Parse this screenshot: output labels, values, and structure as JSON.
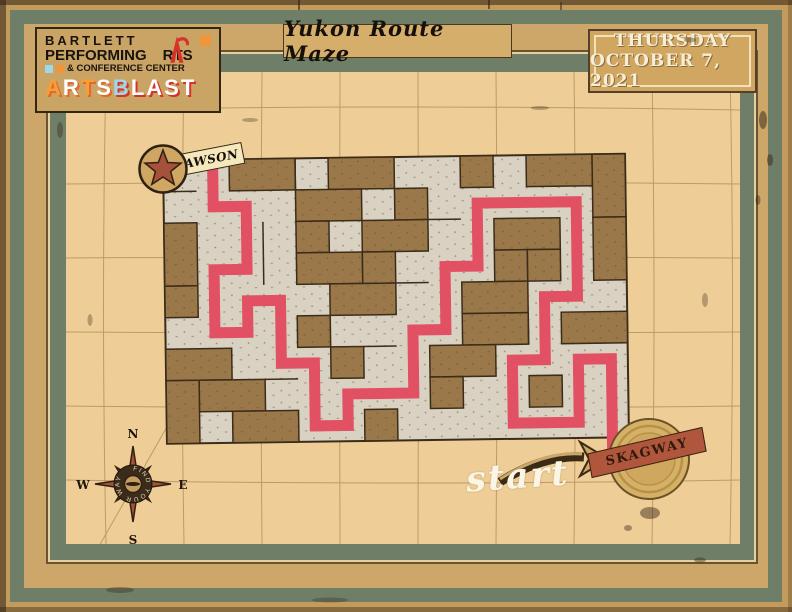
{
  "title": "Yukon Route Maze",
  "event_date": {
    "line1": "THURSDAY",
    "line2": "OCTOBER 7, 2021"
  },
  "logo": {
    "line1": "BARTLETT",
    "line2_pre": "PERFORMING",
    "line2_post": "RTS",
    "line3": "& CONFERENCE CENTER",
    "artsblast": [
      {
        "ch": "A",
        "color": "#f69f36",
        "shadow": "#e4692c"
      },
      {
        "ch": "R",
        "color": "#ffffff",
        "shadow": "#e4692c"
      },
      {
        "ch": "T",
        "color": "#f69f36",
        "shadow": "#e4692c"
      },
      {
        "ch": "S",
        "color": "#ffffff",
        "shadow": "#e4692c"
      },
      {
        "ch": "B",
        "color": "#9ed8ea",
        "shadow": "#d9322b"
      },
      {
        "ch": "L",
        "color": "#ffffff",
        "shadow": "#d9322b"
      },
      {
        "ch": "A",
        "color": "#ffffff",
        "shadow": "#d9322b"
      },
      {
        "ch": "S",
        "color": "#ffffff",
        "shadow": "#d9322b"
      },
      {
        "ch": "T",
        "color": "#ffffff",
        "shadow": "#d9322b"
      }
    ]
  },
  "labels": {
    "start": "start",
    "dawson": "DAWSON",
    "skagway": "SKAGWAY"
  },
  "compass": {
    "n": "N",
    "e": "E",
    "s": "S",
    "w": "W",
    "center_text": "FIND YOUR WAY"
  },
  "colors": {
    "frame_tan": "#c39b5c",
    "frame_teal": "#6f7f67",
    "interior": "#eecd96",
    "maze_corridor": "#d9d2c2",
    "maze_wall": "#9a7849",
    "maze_line": "#3b2c1a",
    "solution": "#e25064",
    "badge_red": "#a6523a",
    "ribbon_red": "#b0563c",
    "medal_gold": "#d5b168",
    "date_box": "#d1a660"
  },
  "maze": {
    "cols": 14,
    "rows": 9,
    "cell_w": 33,
    "cell_h": 31.5,
    "blocks": [
      [
        2,
        0,
        2,
        1
      ],
      [
        5,
        0,
        2,
        1
      ],
      [
        9,
        0,
        1,
        1
      ],
      [
        11,
        0,
        2,
        1
      ],
      [
        4,
        1,
        2,
        1
      ],
      [
        7,
        1,
        1,
        1
      ],
      [
        13,
        0,
        1,
        2
      ],
      [
        0,
        2,
        1,
        2
      ],
      [
        4,
        2,
        1,
        1
      ],
      [
        6,
        2,
        2,
        1
      ],
      [
        10,
        2,
        2,
        1
      ],
      [
        13,
        2,
        1,
        2
      ],
      [
        4,
        3,
        2,
        1
      ],
      [
        6,
        3,
        1,
        1
      ],
      [
        10,
        3,
        1,
        1
      ],
      [
        11,
        3,
        1,
        1
      ],
      [
        0,
        4,
        1,
        1
      ],
      [
        5,
        4,
        2,
        1
      ],
      [
        9,
        4,
        2,
        1
      ],
      [
        4,
        5,
        1,
        1
      ],
      [
        9,
        5,
        2,
        1
      ],
      [
        12,
        5,
        2,
        1
      ],
      [
        0,
        6,
        2,
        1
      ],
      [
        5,
        6,
        1,
        1
      ],
      [
        8,
        6,
        2,
        1
      ],
      [
        1,
        7,
        2,
        1
      ],
      [
        8,
        7,
        1,
        1
      ],
      [
        11,
        7,
        1,
        1
      ],
      [
        0,
        7,
        1,
        2
      ],
      [
        2,
        8,
        2,
        1
      ],
      [
        6,
        8,
        1,
        1
      ]
    ],
    "inner_walls": [
      [
        4,
        0,
        4,
        1
      ],
      [
        0,
        1,
        1,
        1
      ],
      [
        3,
        2,
        3,
        4
      ],
      [
        3,
        7,
        4,
        7
      ],
      [
        8,
        2,
        9,
        2
      ],
      [
        11,
        5,
        11,
        6
      ],
      [
        6,
        6,
        7,
        6
      ],
      [
        7,
        4,
        8,
        4
      ]
    ],
    "solution_path": [
      [
        13,
        9.3
      ],
      [
        13,
        6
      ],
      [
        12,
        6
      ],
      [
        12,
        8
      ],
      [
        10,
        8
      ],
      [
        10,
        6
      ],
      [
        11,
        6
      ],
      [
        11,
        4
      ],
      [
        12,
        4
      ],
      [
        12,
        1
      ],
      [
        9,
        1
      ],
      [
        9,
        3
      ],
      [
        8,
        3
      ],
      [
        8,
        5
      ],
      [
        7,
        5
      ],
      [
        7,
        7
      ],
      [
        5,
        7
      ],
      [
        5,
        8
      ],
      [
        4,
        8
      ],
      [
        4,
        6
      ],
      [
        3,
        6
      ],
      [
        3,
        4
      ],
      [
        2,
        4
      ],
      [
        2,
        5
      ],
      [
        1,
        5
      ],
      [
        1,
        3
      ],
      [
        2,
        3
      ],
      [
        2,
        1
      ],
      [
        1,
        1
      ],
      [
        1,
        -0.6
      ]
    ]
  }
}
